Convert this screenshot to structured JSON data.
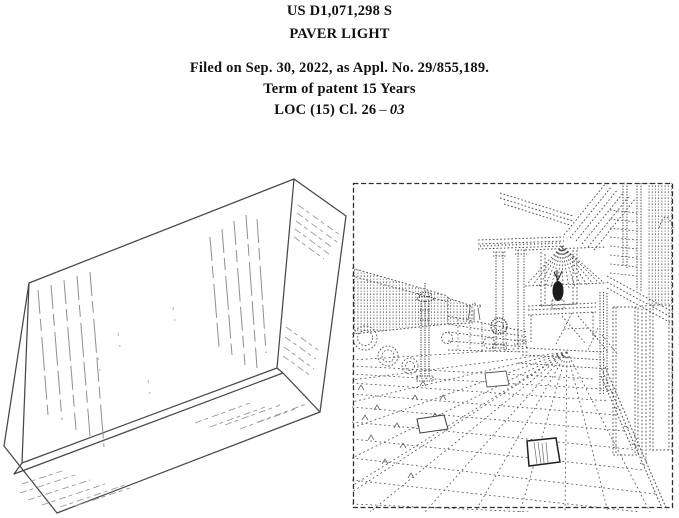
{
  "page": {
    "background": "#ffffff",
    "text_color": "#121212",
    "drawing_line_color": "#474747",
    "hatch_line_color": "#8f8f8f"
  },
  "header": {
    "patent_number": "US D1,071,298 S",
    "design_title": "PAVER LIGHT",
    "filed_line": "Filed on Sep. 30, 2022, as Appl. No. 29/855,189.",
    "term_line": "Term of patent 15 Years",
    "loc_prefix": "LOC (15) Cl. 26",
    "loc_dash": "–",
    "loc_class": "03"
  }
}
